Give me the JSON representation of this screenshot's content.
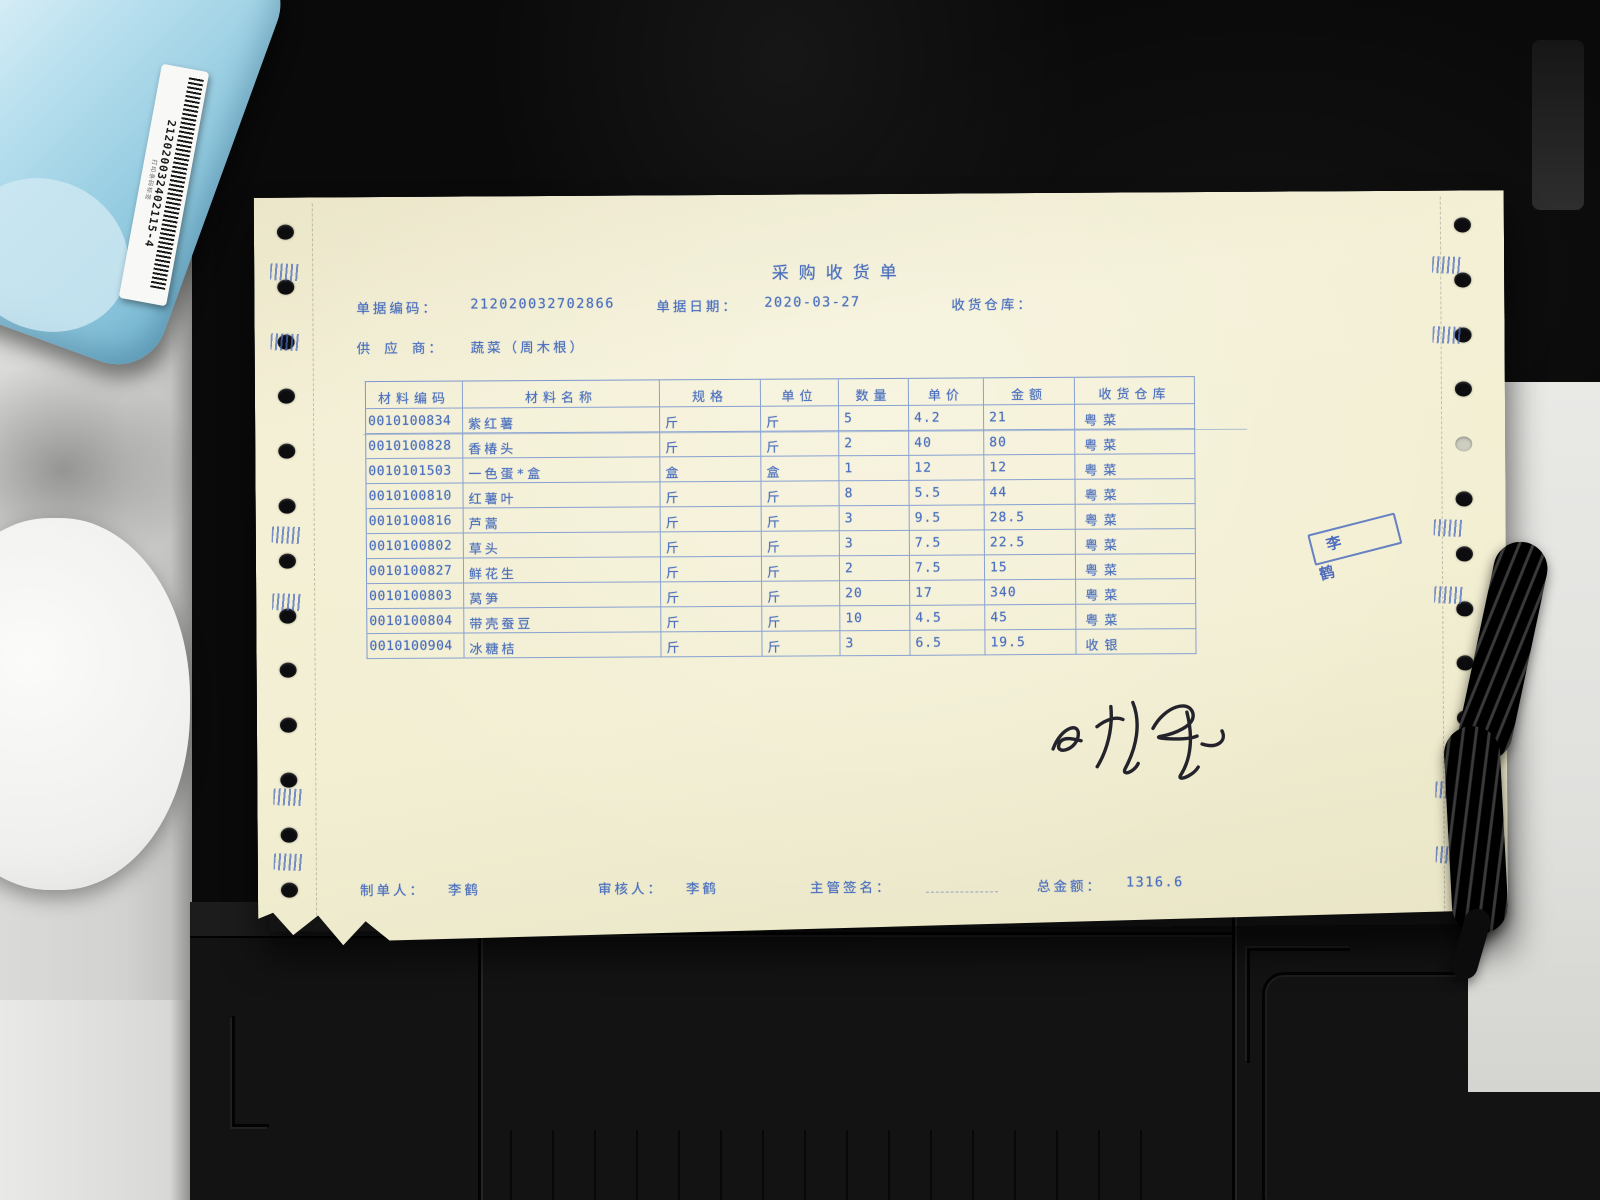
{
  "scene": {
    "barcode_label_number": "212020032402115-4",
    "barcode_label_small_text": "打印条码标签",
    "accent_print_color": "#4a6fbe",
    "paper_color": "#f3efd3",
    "stamp_color": "#4061bd"
  },
  "document": {
    "title": "采购收货单",
    "header": {
      "doc_no_label": "单据编码：",
      "doc_no_value": "212020032702866",
      "date_label": "单据日期：",
      "date_value": "2020-03-27",
      "recv_warehouse_label": "收货仓库：",
      "recv_warehouse_value": "",
      "supplier_label": "供 应 商：",
      "supplier_value": "蔬菜（周木根）"
    },
    "table": {
      "headers": [
        "材料编码",
        "材料名称",
        "规格",
        "单位",
        "数量",
        "单价",
        "金额",
        "收货仓库"
      ],
      "rows": [
        [
          "0010100834",
          "紫红薯",
          "斤",
          "斤",
          "5",
          "4.2",
          "21",
          "粤菜"
        ],
        [
          "0010100828",
          "香椿头",
          "斤",
          "斤",
          "2",
          "40",
          "80",
          "粤菜"
        ],
        [
          "0010101503",
          "一色蛋*盒",
          "盒",
          "盒",
          "1",
          "12",
          "12",
          "粤菜"
        ],
        [
          "0010100810",
          "红薯叶",
          "斤",
          "斤",
          "8",
          "5.5",
          "44",
          "粤菜"
        ],
        [
          "0010100816",
          "芦蒿",
          "斤",
          "斤",
          "3",
          "9.5",
          "28.5",
          "粤菜"
        ],
        [
          "0010100802",
          "草头",
          "斤",
          "斤",
          "3",
          "7.5",
          "22.5",
          "粤菜"
        ],
        [
          "0010100827",
          "鲜花生",
          "斤",
          "斤",
          "2",
          "7.5",
          "15",
          "粤菜"
        ],
        [
          "0010100803",
          "莴笋",
          "斤",
          "斤",
          "20",
          "17",
          "340",
          "粤菜"
        ],
        [
          "0010100804",
          "带壳蚕豆",
          "斤",
          "斤",
          "10",
          "4.5",
          "45",
          "粤菜"
        ],
        [
          "0010100904",
          "冰糖桔",
          "斤",
          "斤",
          "3",
          "6.5",
          "19.5",
          "收银"
        ]
      ]
    },
    "stamp_text": "李鹤",
    "footer": {
      "maker_label": "制单人：",
      "maker_value": "李鹤",
      "auditor_label": "审核人：",
      "auditor_value": "李鹤",
      "supervisor_label": "主管签名：",
      "total_label": "总金额：",
      "total_value": "1316.6"
    }
  }
}
